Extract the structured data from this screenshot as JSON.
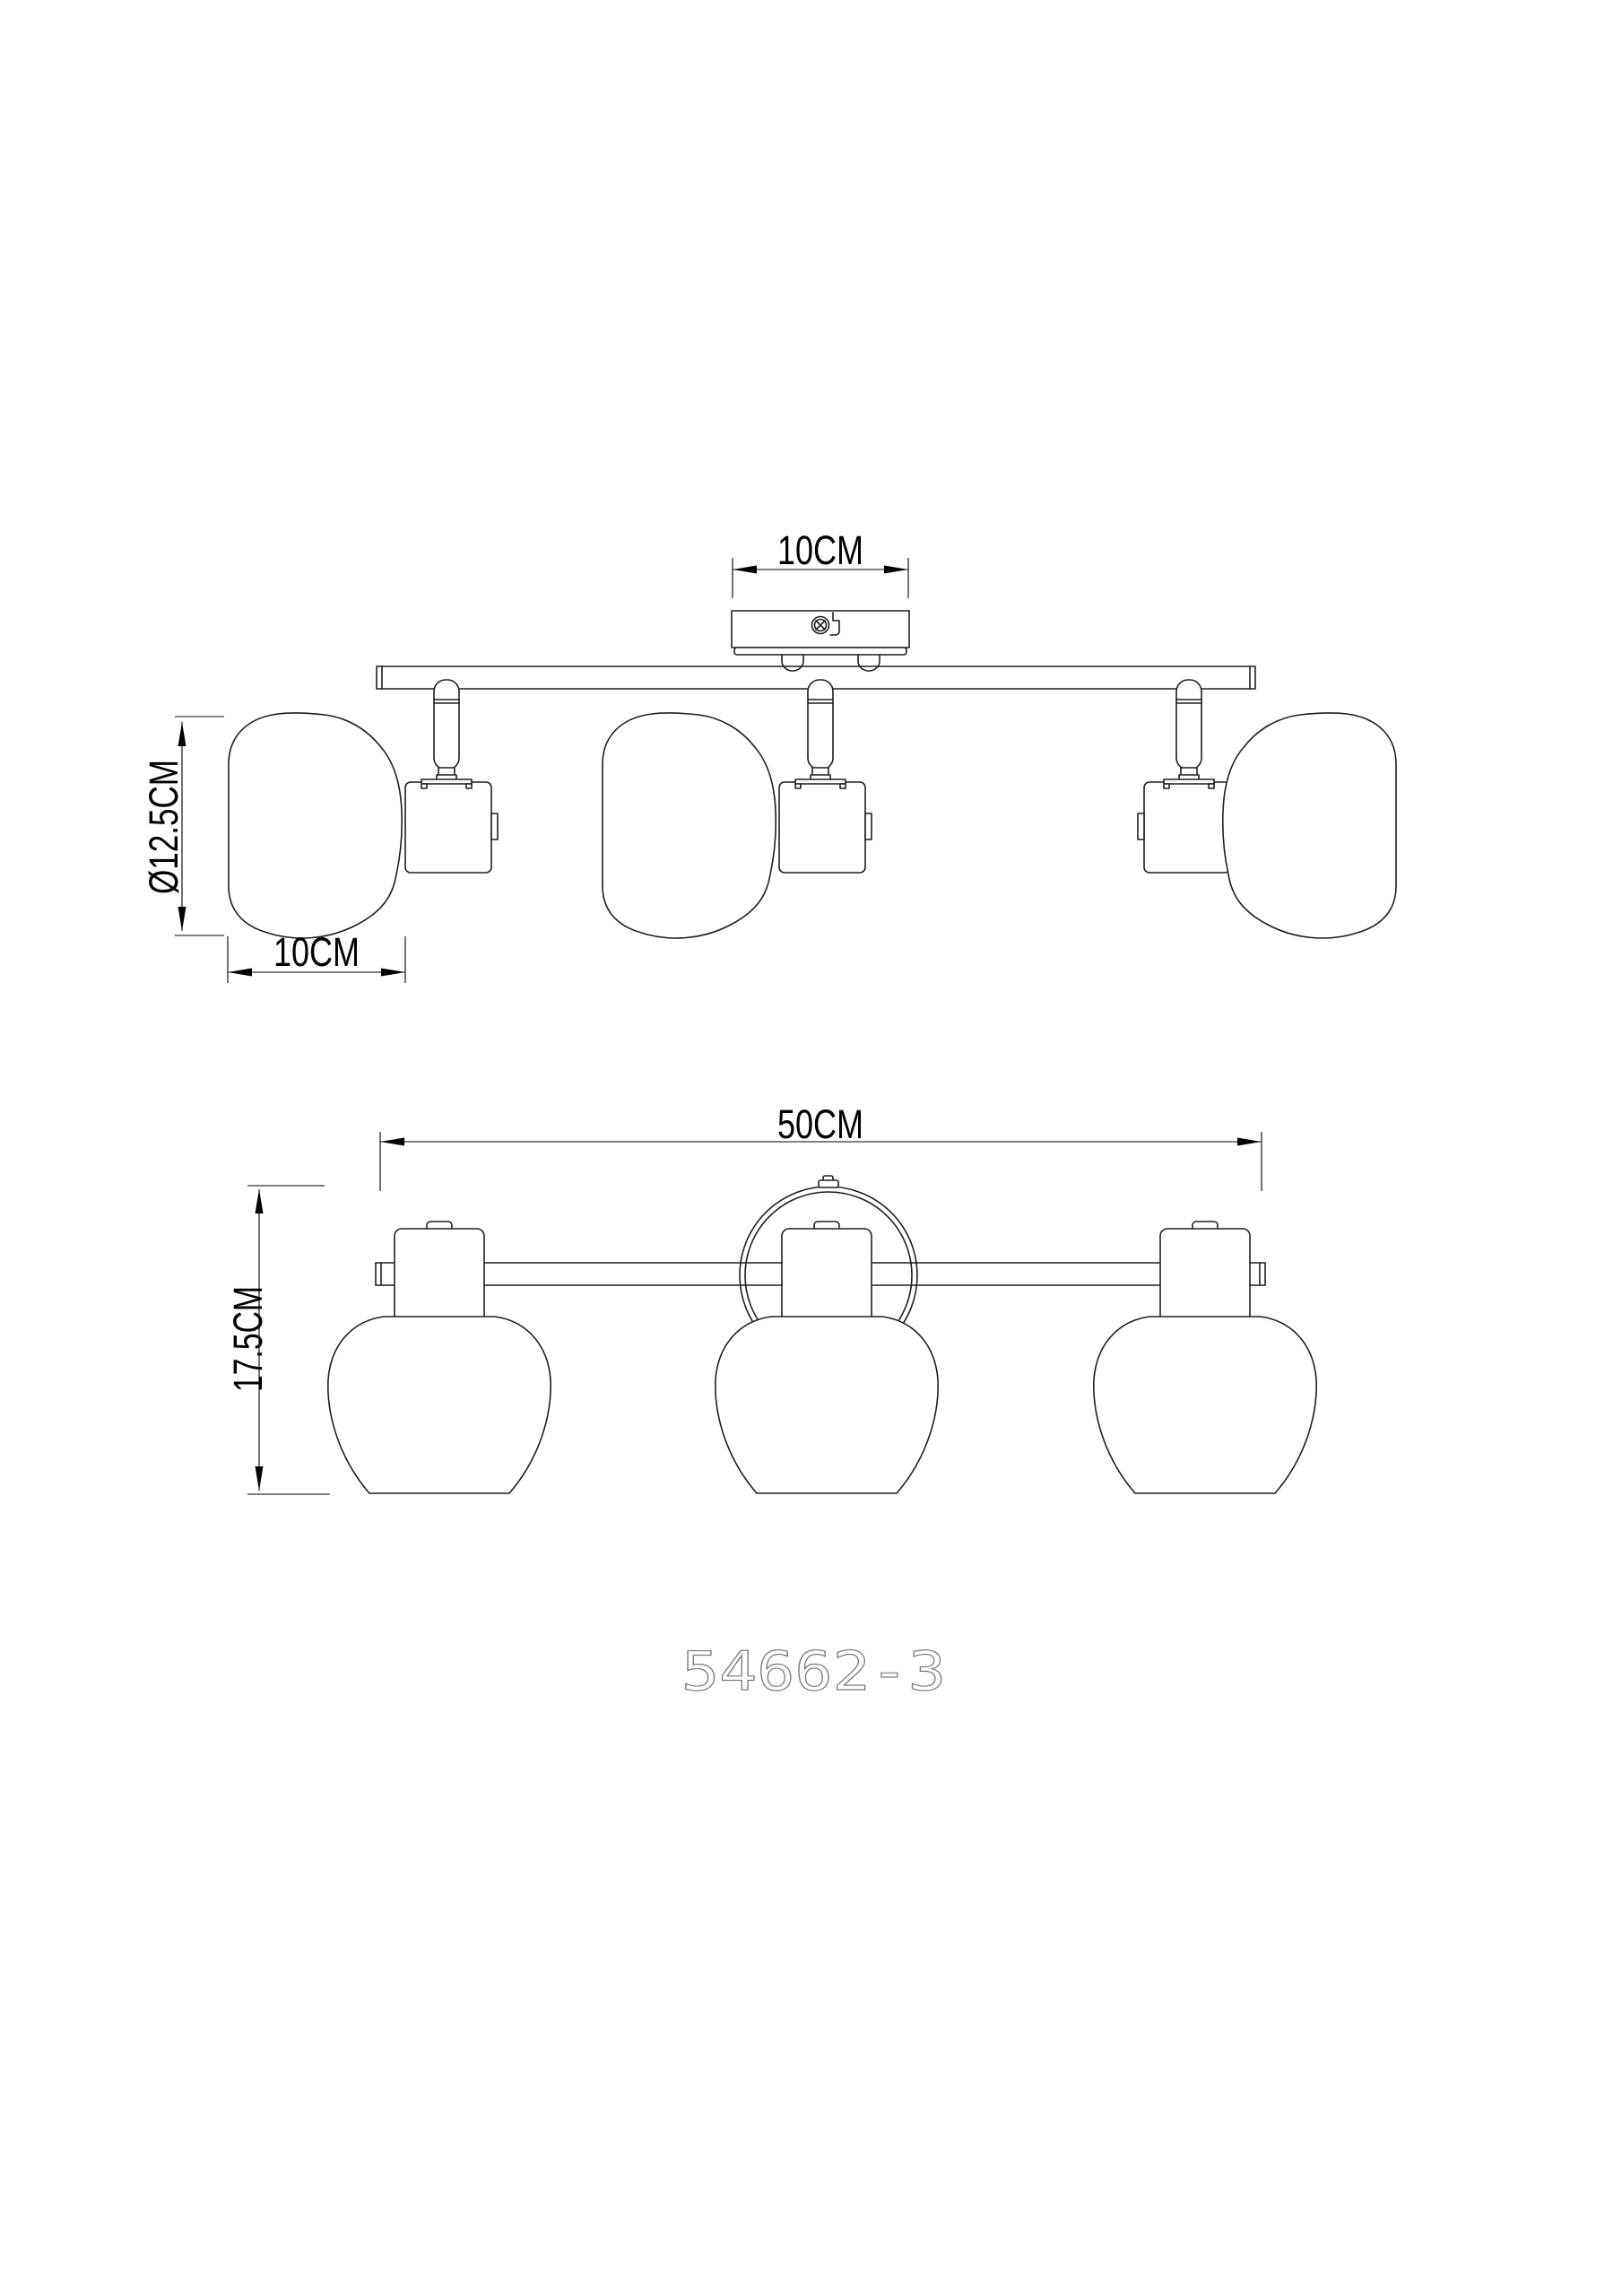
{
  "product": {
    "code": "54662-3"
  },
  "drawing": {
    "type": "technical-dimension-drawing",
    "views": {
      "top": {
        "name": "side view",
        "lamp_count": 3
      },
      "front": {
        "name": "front view",
        "lamp_count": 3
      }
    }
  },
  "dimensions": {
    "plate_width": "10CM",
    "shade_diameter": "Ø12.5CM",
    "shade_width": "10CM",
    "total_width": "50CM",
    "fixture_height": "17.5CM"
  },
  "colors": {
    "background": "#ffffff",
    "line": "#1f1f1f",
    "dimension": "#000000",
    "part_number": "#7d7d7d"
  }
}
